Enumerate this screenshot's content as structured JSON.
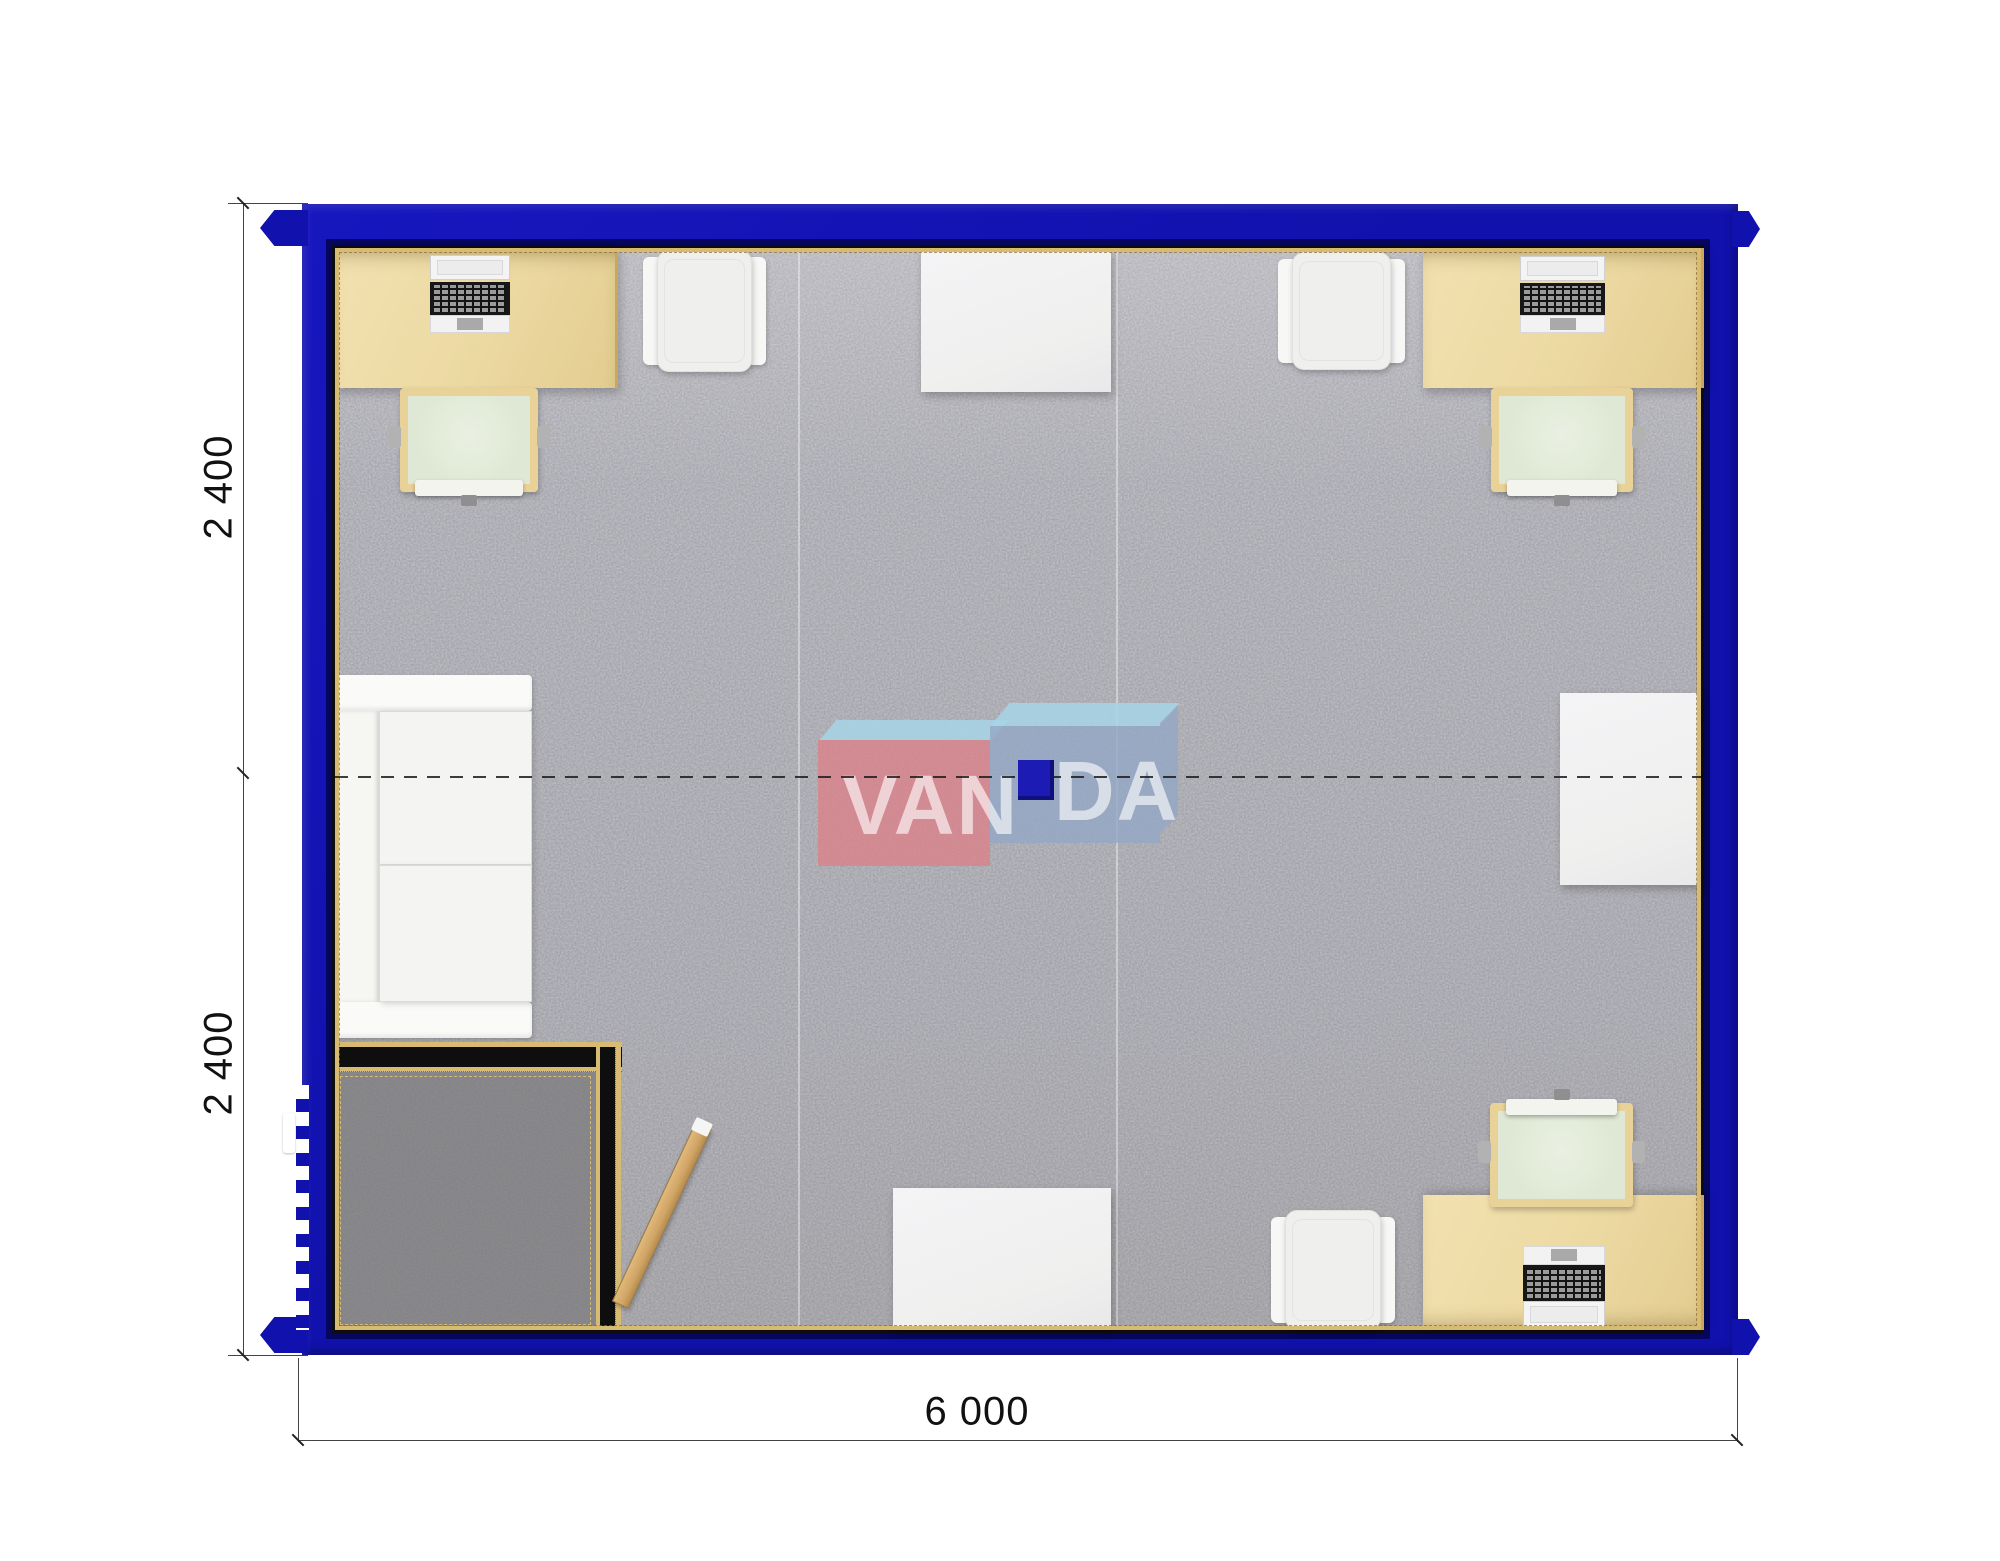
{
  "plan": {
    "type": "modular-container-office-floor-plan",
    "dimensions": {
      "left_top_label": "2 400",
      "left_bottom_label": "2 400",
      "bottom_label": "6 000"
    },
    "logo": {
      "text_left": "VAN",
      "text_right": "DA",
      "full": "VANDA"
    },
    "furniture": [
      "desk-top-left-with-laptop",
      "office-chair-top-left",
      "armchair-top-left",
      "meeting-table-top-center",
      "armchair-top-right",
      "desk-top-right-with-laptop",
      "office-chair-top-right",
      "sofa-left-wall",
      "table-right-wall",
      "entrance-vestibule-with-dark-mat",
      "entrance-door-open",
      "exterior-door-left-wall",
      "meeting-table-bottom-center",
      "armchair-bottom-right",
      "desk-bottom-right-with-laptop",
      "office-chair-bottom-right",
      "module-joint-centerline",
      "center-connector-block"
    ]
  },
  "palette": {
    "wall_blue": "#1111ad",
    "wall_blue_bright": "#1717bf",
    "wall_blue_dark": "#06065f",
    "line_black": "#0d0d0d",
    "trim_gold": "#d8bb72",
    "trim_gold_dark": "#8a6c28",
    "carpet": "#c7c7cc",
    "mat_dark": "#8d8d8d",
    "desk": "#ecd9a2",
    "desk_edge": "#c9a75e",
    "chair_frame": "#e9d297",
    "chair_seat": "#dfe8d4",
    "white_obj": "#efefee",
    "sofa_white": "#f4f4f2",
    "laptop_black": "#171717",
    "laptop_keys": "#9b9b9b",
    "door_tan": "#d0a566",
    "logo_pink": "rgba(221,128,137,0.78)",
    "logo_blue": "rgba(147,167,197,0.8)",
    "logo_sky": "rgba(167,213,231,0.85)",
    "logo_navy": "#1c1cb5",
    "dim_line": "#444444",
    "dim_text": "#111111"
  }
}
